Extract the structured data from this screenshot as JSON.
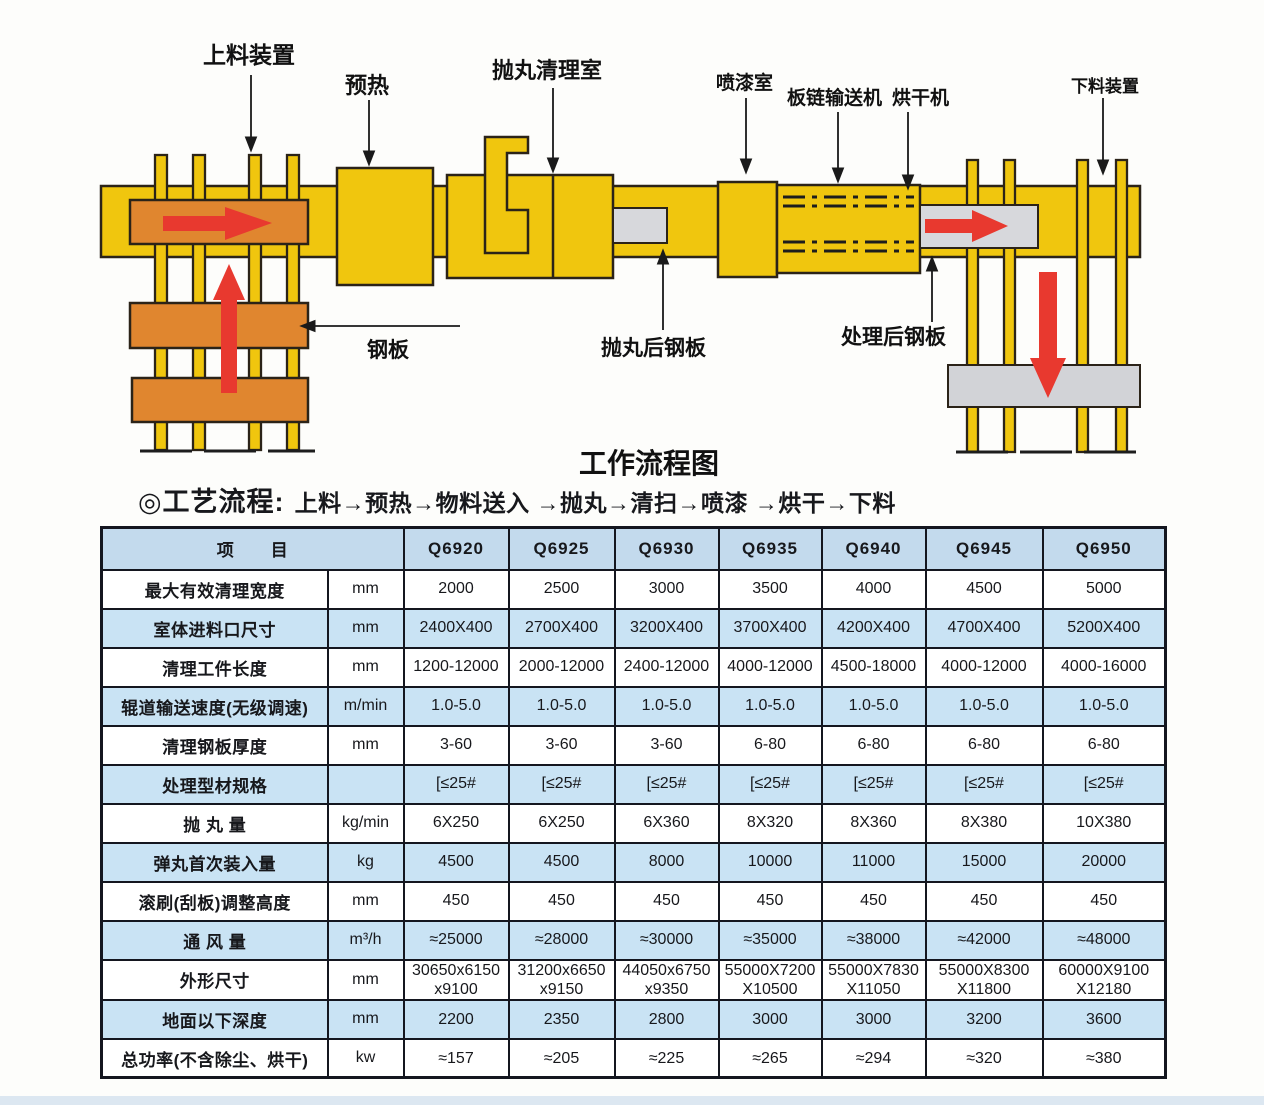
{
  "diagram": {
    "title": "工作流程图",
    "labels": {
      "loading_device": "上料装置",
      "preheat": "预热",
      "blast_room": "抛丸清理室",
      "paint_room": "喷漆室",
      "chain_conveyor": "板链输送机",
      "dryer": "烘干机",
      "unloading_device": "下料装置",
      "steel_plate": "钢板",
      "blasted_plate": "抛丸后钢板",
      "treated_plate": "处理后钢板"
    },
    "colors": {
      "machine_yellow": "#F0C60E",
      "plate_orange": "#E0862F",
      "arrow_red": "#E8392F",
      "plate_gray": "#D7D8DC",
      "outline": "#2B2318",
      "table_header_blue": "#C3DAED",
      "table_row_blue": "#C9E3F4"
    }
  },
  "process_flow": {
    "label": "◎工艺流程:",
    "steps": "上料→预热→物料送入 →抛丸→清扫→喷漆 →烘干→下料"
  },
  "spec_table": {
    "item_header": "项　　目",
    "models": [
      "Q6920",
      "Q6925",
      "Q6930",
      "Q6935",
      "Q6940",
      "Q6945",
      "Q6950"
    ],
    "rows": [
      {
        "name": "最大有效清理宽度",
        "unit": "mm",
        "values": [
          "2000",
          "2500",
          "3000",
          "3500",
          "4000",
          "4500",
          "5000"
        ]
      },
      {
        "name": "室体进料口尺寸",
        "unit": "mm",
        "values": [
          "2400X400",
          "2700X400",
          "3200X400",
          "3700X400",
          "4200X400",
          "4700X400",
          "5200X400"
        ]
      },
      {
        "name": "清理工件长度",
        "unit": "mm",
        "values": [
          "1200-12000",
          "2000-12000",
          "2400-12000",
          "4000-12000",
          "4500-18000",
          "4000-12000",
          "4000-16000"
        ]
      },
      {
        "name": "辊道输送速度(无级调速)",
        "unit": "m/min",
        "values": [
          "1.0-5.0",
          "1.0-5.0",
          "1.0-5.0",
          "1.0-5.0",
          "1.0-5.0",
          "1.0-5.0",
          "1.0-5.0"
        ]
      },
      {
        "name": "清理钢板厚度",
        "unit": "mm",
        "values": [
          "3-60",
          "3-60",
          "3-60",
          "6-80",
          "6-80",
          "6-80",
          "6-80"
        ]
      },
      {
        "name": "处理型材规格",
        "unit": "",
        "values": [
          "[≤25#",
          "[≤25#",
          "[≤25#",
          "[≤25#",
          "[≤25#",
          "[≤25#",
          "[≤25#"
        ]
      },
      {
        "name": "抛 丸 量",
        "unit": "kg/min",
        "values": [
          "6X250",
          "6X250",
          "6X360",
          "8X320",
          "8X360",
          "8X380",
          "10X380"
        ]
      },
      {
        "name": "弹丸首次装入量",
        "unit": "kg",
        "values": [
          "4500",
          "4500",
          "8000",
          "10000",
          "11000",
          "15000",
          "20000"
        ]
      },
      {
        "name": "滚刷(刮板)调整高度",
        "unit": "mm",
        "values": [
          "450",
          "450",
          "450",
          "450",
          "450",
          "450",
          "450"
        ]
      },
      {
        "name": "通 风 量",
        "unit": "m³/h",
        "values": [
          "≈25000",
          "≈28000",
          "≈30000",
          "≈35000",
          "≈38000",
          "≈42000",
          "≈48000"
        ]
      },
      {
        "name": "外形尺寸",
        "unit": "mm",
        "values": [
          "30650x6150\nx9100",
          "31200x6650\nx9150",
          "44050x6750\nx9350",
          "55000X7200\nX10500",
          "55000X7830\nX11050",
          "55000X8300\nX11800",
          "60000X9100\nX12180"
        ]
      },
      {
        "name": "地面以下深度",
        "unit": "mm",
        "values": [
          "2200",
          "2350",
          "2800",
          "3000",
          "3000",
          "3200",
          "3600"
        ]
      },
      {
        "name": "总功率(不含除尘、烘干)",
        "unit": "kw",
        "values": [
          "≈157",
          "≈205",
          "≈225",
          "≈265",
          "≈294",
          "≈320",
          "≈380"
        ]
      }
    ]
  }
}
